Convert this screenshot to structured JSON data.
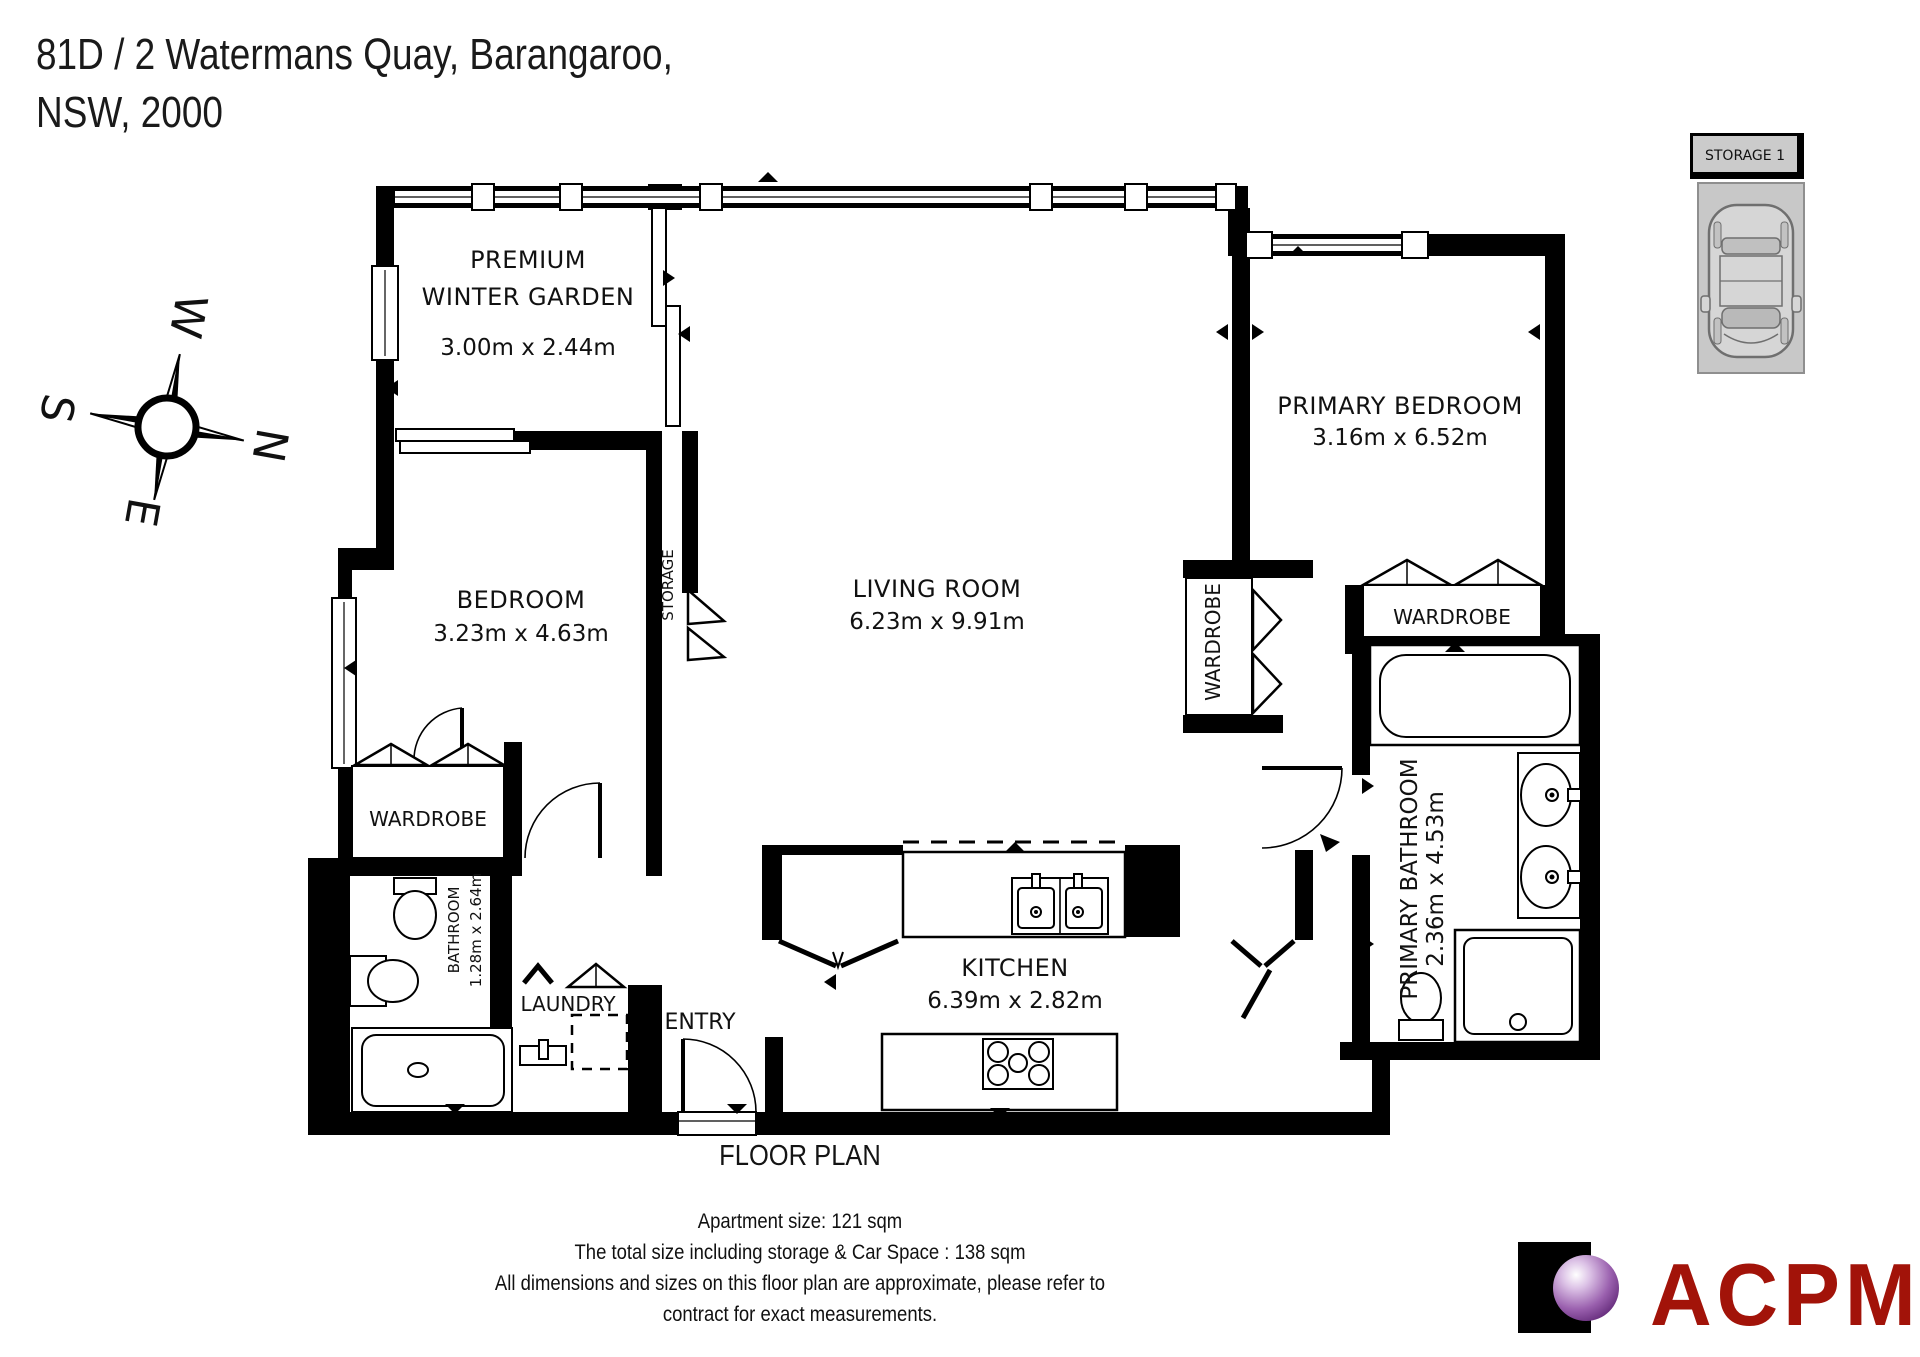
{
  "title": {
    "line1": "81D /  2 Watermans Quay, Barangaroo,",
    "line2": "NSW, 2000"
  },
  "compass": {
    "north": "N",
    "south": "S",
    "east": "E",
    "west": "W"
  },
  "plan": {
    "caption": "FLOOR PLAN",
    "rooms": {
      "winter_garden": {
        "label1": "PREMIUM",
        "label2": "WINTER GARDEN",
        "dims": "3.00m x 2.44m"
      },
      "bedroom": {
        "label": "BEDROOM",
        "dims": "3.23m x 4.63m"
      },
      "living_room": {
        "label": "LIVING ROOM",
        "dims": "6.23m x 9.91m"
      },
      "primary_bedroom": {
        "label": "PRIMARY BEDROOM",
        "dims": "3.16m x 6.52m"
      },
      "kitchen": {
        "label": "KITCHEN",
        "dims": "6.39m x 2.82m"
      },
      "primary_bathroom": {
        "label": "PRIMARY BATHROOM",
        "dims": "2.36m x 4.53m"
      },
      "bathroom": {
        "label": "BATHROOM",
        "dims": "1.28m x 2.64m"
      },
      "storage": {
        "label": "STORAGE"
      },
      "laundry": {
        "label": "LAUNDRY"
      },
      "entry": {
        "label": "ENTRY"
      },
      "wardrobe_bedroom": {
        "label": "WARDROBE"
      },
      "wardrobe_hall": {
        "label": "WARDROBE"
      },
      "wardrobe_primary": {
        "label": "WARDROBE"
      }
    }
  },
  "parking": {
    "storage_box": "STORAGE 1"
  },
  "footer": {
    "line1": "Apartment size: 121 sqm",
    "line2": "The total size including storage & Car Space : 138 sqm",
    "line3": "All dimensions and sizes on this floor plan are approximate, please refer to",
    "line4": "contract for exact measurements."
  },
  "logo": {
    "text": "ACPM"
  },
  "colors": {
    "wall": "#000000",
    "parking_fill": "#c8c8c8",
    "logo_red": "#a21309",
    "logo_purple": "#6a3180"
  }
}
